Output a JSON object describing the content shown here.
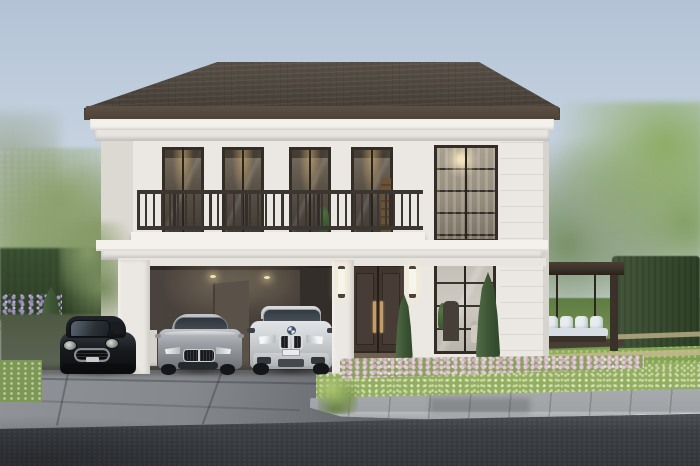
{
  "meta": {
    "type": "architectural-exterior-render",
    "subject": "Modern classic two-story white detached house with double garage, three cars, landscaped garden and swing pergola",
    "time_of_day": "day",
    "width_px": 700,
    "height_px": 466
  },
  "palette": {
    "sky_top": "#b3c3d6",
    "sky_mid": "#ccd7e3",
    "sky_bottom": "#e9edf2",
    "roof_light": "#5a5249",
    "roof_dark": "#474038",
    "fascia": "#4f4337",
    "wall": "#ebe7e2",
    "wall_shade": "#dcd8d2",
    "trim": "#f4f1ec",
    "trim2": "#e8e5e0",
    "frame": "#342d26",
    "garage_mid": "#4a423d",
    "garage_dark": "#3a332f",
    "door": "#41362e",
    "brass": "#c59d64",
    "rail": "#3b3632",
    "grass": "#83a055",
    "grass_bright": "#93ad62",
    "hedge": "#3c5233",
    "hedge_dark": "#2e4127",
    "conifer": "#3c5434",
    "tree1": "#8ba06c",
    "tree2": "#7e9360",
    "pink": "#dcc0cf",
    "purple": "#a193bf",
    "drive": "#84878c",
    "drive_dark": "#54575b",
    "road": "#3a3d41",
    "walk": "#9b9ea2",
    "pergola": "#3a322a",
    "cushion": "#e8ecef",
    "mini_black": "#17191d",
    "sedan_silver": "#9da1a6",
    "suv_white": "#d3d6d9"
  },
  "scene": {
    "sky": {
      "label": "clear light-blue sky"
    },
    "house": {
      "label": "two-story white house with dark hip roof",
      "balcony": {
        "label": "full-width second-floor balcony",
        "window_count": 4,
        "railing": "dark metal balusters"
      },
      "tall_window_column": {
        "label": "double-height black-framed window wing",
        "count": 2,
        "detail": "chandelier glow and sheer curtain upstairs, living room downstairs"
      },
      "garage": {
        "label": "open double garage",
        "ceiling_lights": 2
      },
      "front_door": {
        "label": "dark brown double door with brass pull handles",
        "steps": 3
      },
      "sconces": {
        "label": "vertical glowing wall lanterns",
        "count": 2
      }
    },
    "vehicles": [
      {
        "name": "mini-hatchback",
        "color_name": "black",
        "location": "parked left of garage"
      },
      {
        "name": "bmw-sedan",
        "color_name": "silver",
        "location": "garage left bay"
      },
      {
        "name": "bmw-suv",
        "color_name": "white",
        "location": "garage right bay"
      }
    ],
    "landscape": {
      "left": {
        "items": [
          "deciduous tree",
          "boxwood hedge",
          "purple flower bed",
          "conifer"
        ]
      },
      "right": {
        "items": [
          "lawn",
          "pink flower bed",
          "two cypress conifers",
          "pergola swing bench with white cushions",
          "tall hedge wall",
          "background trees",
          "stone garden paths"
        ]
      },
      "foreground": {
        "items": [
          "concrete driveway",
          "stone curb",
          "paver sidewalk",
          "asphalt road",
          "curbside shrub"
        ]
      }
    }
  }
}
